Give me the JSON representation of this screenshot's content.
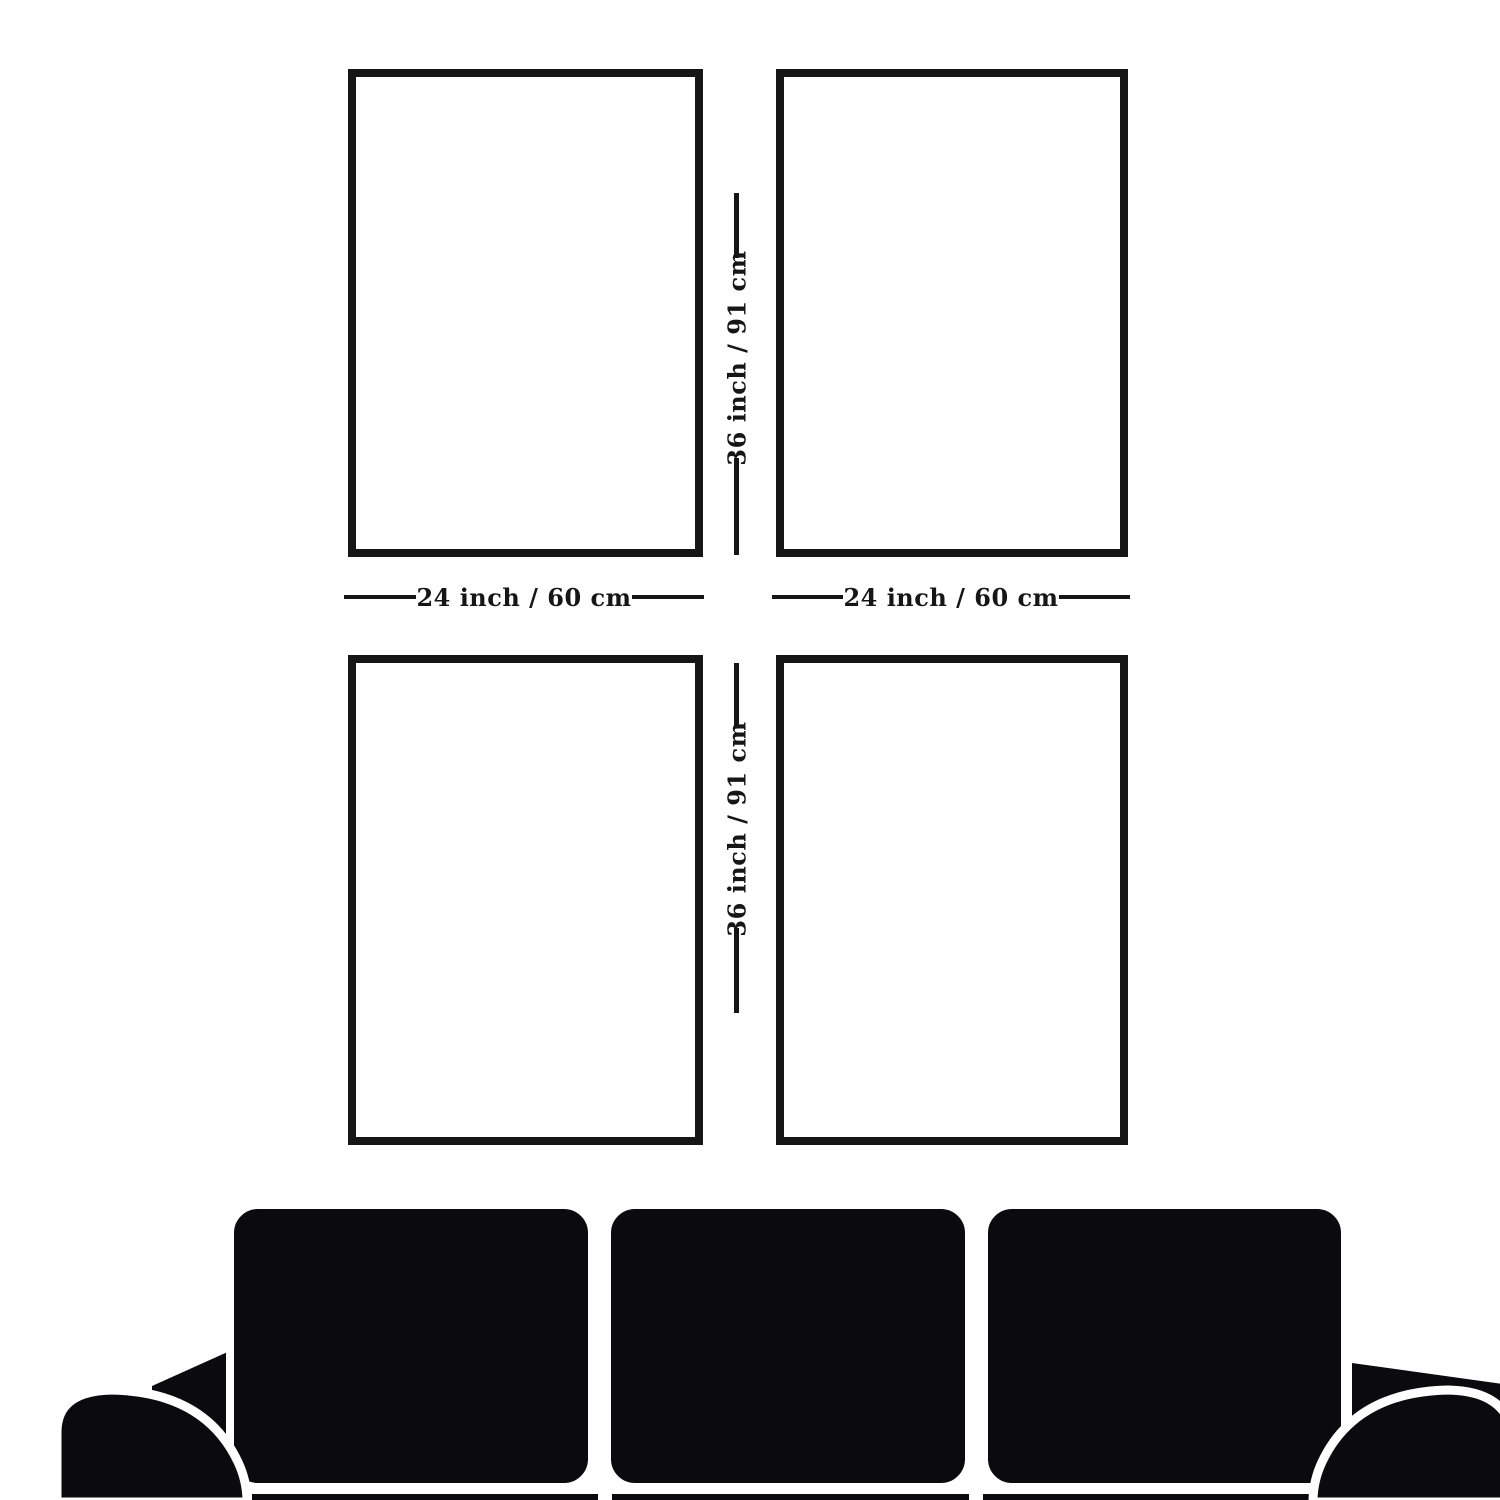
{
  "diagram": {
    "type": "wall-art-size-guide",
    "frame_count": 4,
    "grid": "2x2"
  },
  "dimensions": {
    "width_label": "24 inch / 60 cm",
    "height_label": "36 inch / 91 cm"
  },
  "sofa": {
    "icon": "sofa-silhouette"
  },
  "colors": {
    "background": "#ffffff",
    "ink": "#161616",
    "sofa": "#0b0b0d"
  }
}
